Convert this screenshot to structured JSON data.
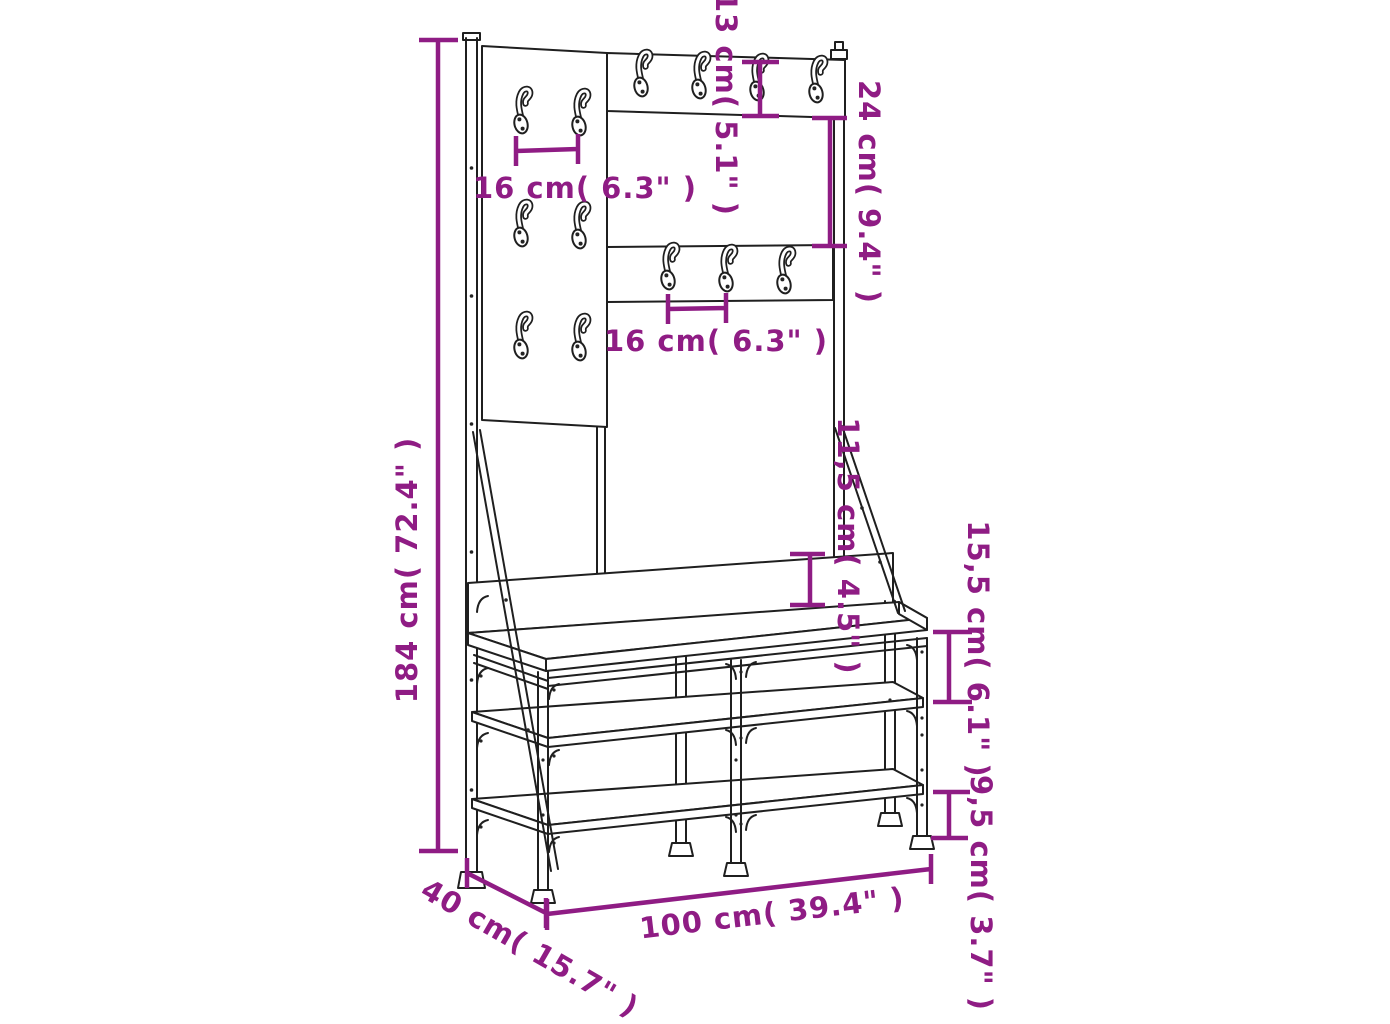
{
  "diagram": {
    "type": "furniture-dimension-drawing",
    "colors": {
      "dimension_annotation": "#8f1c84",
      "drawing_line": "#1f1f1f",
      "background": "#ffffff"
    },
    "labels": {
      "total_height": "184 cm( 72.4\" )",
      "top_rail_height": "13 cm( 5.1\" )",
      "rail_gap": "24 cm( 9.4\" )",
      "hook_spacing_upper": "16 cm( 6.3\" )",
      "hook_spacing_lower": "16 cm( 6.3\" )",
      "backrest_height": "11,5 cm( 4.5\" )",
      "upper_shelf_clearance": "15,5 cm( 6.1\" )",
      "lower_shelf_clearance": "9,5 cm( 3.7\" )",
      "width": "100 cm( 39.4\" )",
      "depth": "40 cm( 15.7\" )"
    }
  }
}
